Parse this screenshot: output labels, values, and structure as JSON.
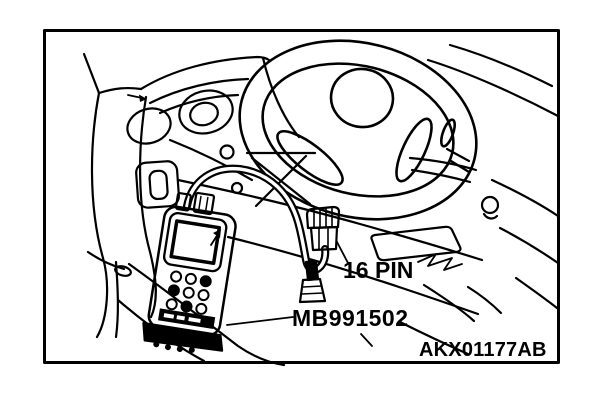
{
  "figure": {
    "kind": "service-manual line illustration",
    "description": "Scan tool connected by cable to the 16-pin data link connector under the instrument panel, steering wheel at right",
    "background_color": "#ffffff",
    "line_color": "#000000",
    "labels": {
      "connector": "16 PIN",
      "tool": "MB991502",
      "figure_code": "AKX01177AB"
    },
    "parts": [
      "frame-border",
      "steering-wheel",
      "instrument-cluster",
      "dashboard",
      "air-vent",
      "switch-blank",
      "scan-tool",
      "diagnostic-cable",
      "16-pin-connector",
      "leader-lines"
    ]
  }
}
